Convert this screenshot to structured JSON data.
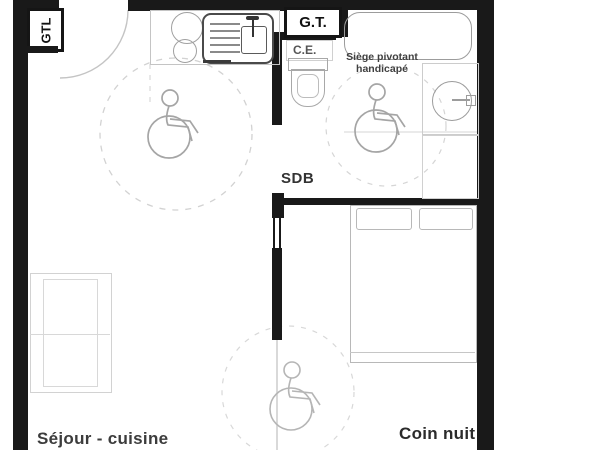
{
  "labels": {
    "gtl": "GTL",
    "gt": "G.T.",
    "ce": "C.E.",
    "seat_note": "Siège pivotant handicapé",
    "bathroom": "SDB",
    "living": "Séjour - cuisine",
    "bedroom": "Coin nuit"
  },
  "icons": {
    "wheelchair": "wheelchair-accessibility-symbol",
    "turning_circle": "wheelchair-turning-circle",
    "sink": "kitchen-sink-with-drainer",
    "burners": "cooktop-burners",
    "bathtub": "bathtub",
    "washbasin": "round-washbasin",
    "toilet": "toilet",
    "bed": "double-bed-with-pillows",
    "door_arc": "door-swing-arc"
  },
  "colors": {
    "wall": "#191919",
    "label_text": "#2d2d2d",
    "fixture_stroke": "#9c9c9c",
    "faint_stroke": "#c9c9c9",
    "background": "#ffffff"
  }
}
